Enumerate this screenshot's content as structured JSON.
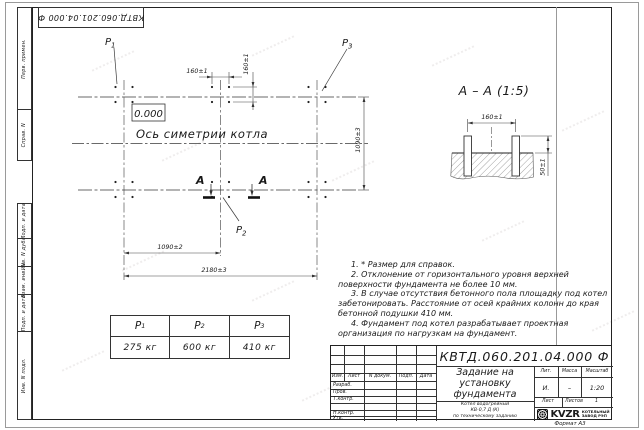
{
  "sheet": {
    "stamp_rotated": "КВТД.060.201.04.000 Ф",
    "format_label": "Формат А3",
    "side_labels": [
      "Перв. примен.",
      "Справ. N",
      "Подп. и дата",
      "Инв. N дубл.",
      "Взам. инв. N",
      "Подп. и дата",
      "Инв. N подл."
    ]
  },
  "plan": {
    "elevation": "0.000",
    "axis_label": "Ось симетрии котла",
    "section_letter": "А",
    "dims": {
      "bolt_dx": "160±1",
      "bolt_dy": "160±1",
      "half_span": "1090±2",
      "full_span": "2180±3",
      "row_span": "1090±3"
    }
  },
  "section": {
    "title": "А – А (1:5)",
    "dims": {
      "bolt_dx": "160±1",
      "protrusion": "50±1"
    }
  },
  "loads": [
    {
      "label": "P",
      "sub": "1",
      "value": "275 кг"
    },
    {
      "label": "P",
      "sub": "2",
      "value": "600 кг"
    },
    {
      "label": "P",
      "sub": "3",
      "value": "410 кг"
    }
  ],
  "notes": {
    "items": [
      "1. * Размер для справок.",
      "2. Отклонение от горизонтального уровня верхней поверхности фундамента не более 10 мм.",
      "3. В случае отсутствия бетонного пола площадку под котел забетонировать. Расстояние от осей крайних колонн до края бетонной подушки 410 мм.",
      "4. Фундамент под котел разрабатывает проектная организация по нагрузкам на фундамент."
    ]
  },
  "titleblock": {
    "designation": "КВТД.060.201.04.000 Ф",
    "title_lines": [
      "Задание на",
      "установку",
      "фундамента"
    ],
    "product_lines": [
      "Котел водогрейный",
      "КВ-0,7 Д (К)",
      "по техническому заданию"
    ],
    "cols": {
      "izm": "Изм.",
      "list": "Лист",
      "doc": "N докум.",
      "sign": "Подп.",
      "date": "Дата"
    },
    "rows": [
      "Разраб.",
      "Пров.",
      "Т.контр.",
      "",
      "Н.контр.",
      "Утв."
    ],
    "lit": {
      "label": "Лит.",
      "value": "И."
    },
    "mass": {
      "label": "Масса",
      "value": "–"
    },
    "scale": {
      "label": "Масштаб",
      "value": "1:20"
    },
    "sheet": {
      "label": "Лист",
      "value": ""
    },
    "sheets": {
      "label": "Листов",
      "value": "1"
    },
    "logo": {
      "text": "KVZR",
      "company_line1": "КОТЕЛЬНЫЙ",
      "company_line2": "ЗАВОД РЭП"
    }
  }
}
